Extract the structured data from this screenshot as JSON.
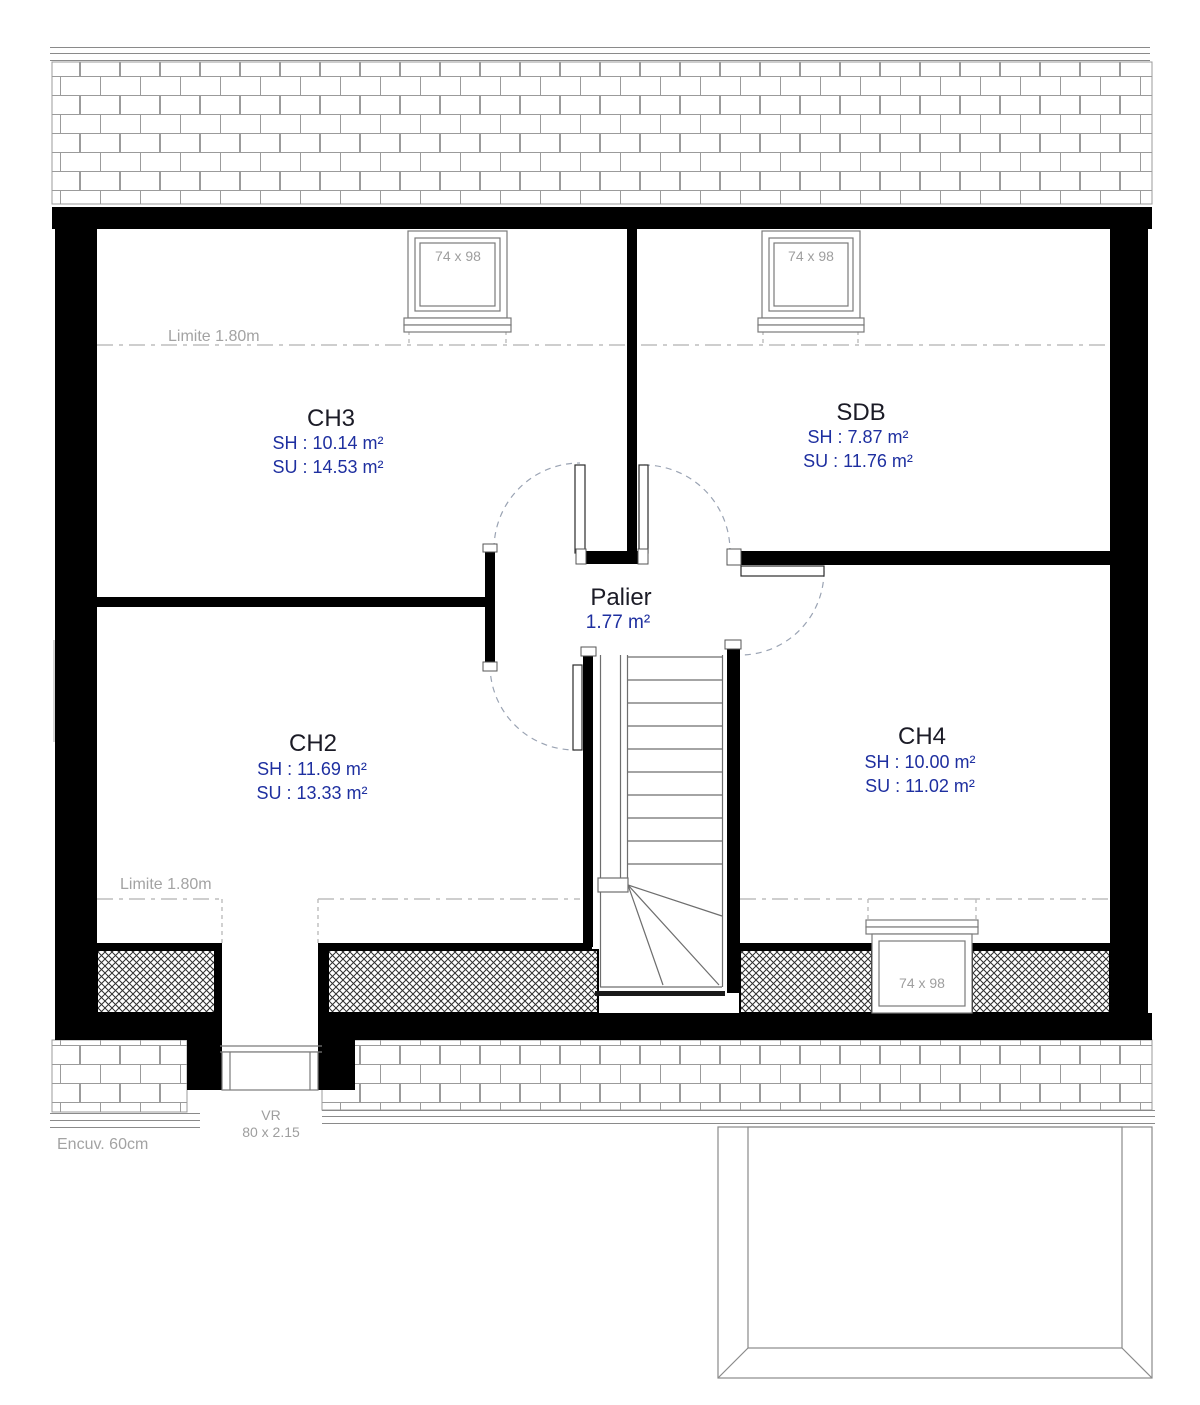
{
  "plan": {
    "rooms": {
      "ch3": {
        "name": "CH3",
        "sh": "SH : 10.14 m²",
        "su": "SU : 14.53 m²"
      },
      "sdb": {
        "name": "SDB",
        "sh": "SH : 7.87 m²",
        "su": "SU : 11.76 m²"
      },
      "ch2": {
        "name": "CH2",
        "sh": "SH : 11.69 m²",
        "su": "SU : 13.33 m²"
      },
      "ch4": {
        "name": "CH4",
        "sh": "SH : 10.00 m²",
        "su": "SU : 11.02 m²"
      },
      "palier": {
        "name": "Palier",
        "area": "1.77 m²"
      }
    },
    "windows": {
      "skylights": [
        "74 x 98",
        "74 x 98",
        "74 x 98"
      ],
      "vr": {
        "label": "VR",
        "size": "80 x 2.15"
      }
    },
    "annotations": {
      "limit_top": "Limite 1.80m",
      "limit_bottom": "Limite 1.80m",
      "encuvement": "Encuv. 60cm"
    },
    "colors": {
      "wall": "#000000",
      "area_text_blue": "#1e2fa0",
      "room_title": "#1b1b26",
      "muted_gray_text": "#a3a3a3",
      "drawing_line_gray": "#8a8a8a",
      "door_arc": "#9aa3b3"
    }
  }
}
